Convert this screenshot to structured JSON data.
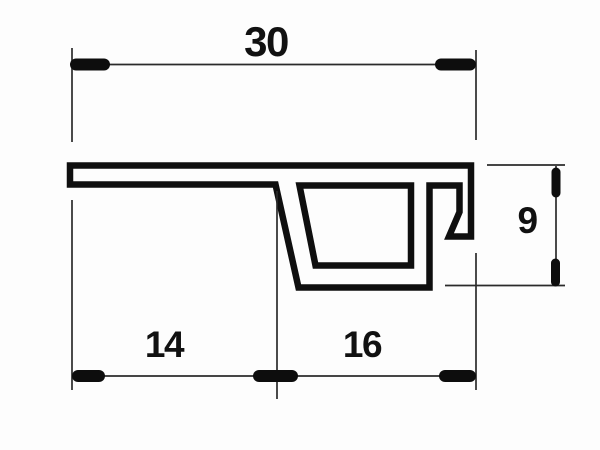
{
  "drawing": {
    "labels": {
      "total_width": "30",
      "left_segment": "14",
      "right_segment": "16",
      "height": "9"
    },
    "colors": {
      "profile_stroke": "#0f0f0f",
      "thin_line": "#2b2b2b",
      "tick": "#0d0d0d",
      "background": "#fdfdfd",
      "text": "#111111"
    }
  }
}
